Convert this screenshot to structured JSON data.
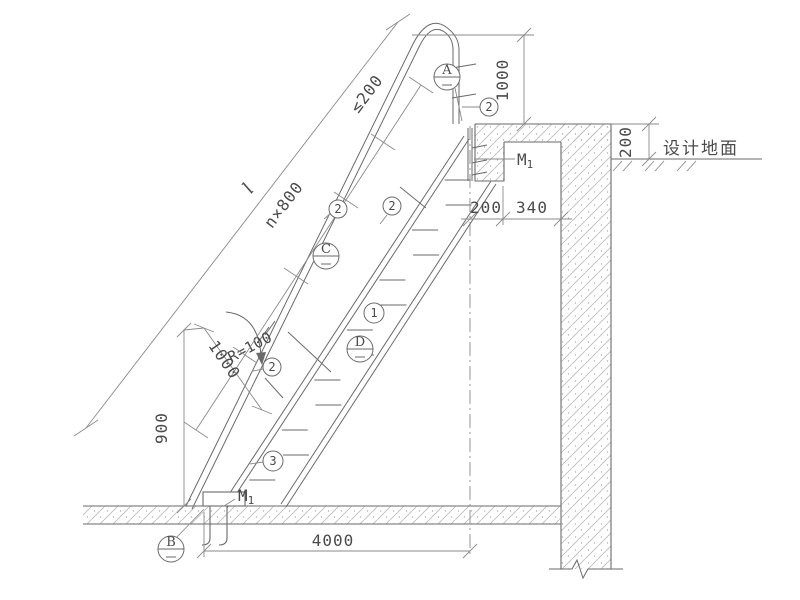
{
  "drawing": {
    "type": "inclined steel ladder / stair section detail (CAD)",
    "labels": {
      "design_ground": "设计地面",
      "rail_extension_height": "1000",
      "parapet_above_ground": "200",
      "ledge_width_1": "200",
      "ledge_width_2": "340",
      "top_clearance": "≤200",
      "rung_spacing": "n×800",
      "overall_length": "l",
      "rail_offset": "1000",
      "bottom_height": "900",
      "bend_radius": "R=100",
      "horizontal_run": "4000",
      "embed_plate": "M",
      "embed_plate_sub": "1",
      "base_plate": "M",
      "base_plate_sub": "1"
    },
    "markers": {
      "section_a": "A",
      "section_b": "B",
      "section_c": "C",
      "section_d": "D",
      "part_1": "1",
      "part_2": "2",
      "part_3": "3"
    },
    "colors": {
      "line": "#6a6a6a",
      "dim_line": "#8a8a8a",
      "text": "#4a4a4a",
      "hatch": "#bdbdbd",
      "background": "#ffffff"
    }
  }
}
